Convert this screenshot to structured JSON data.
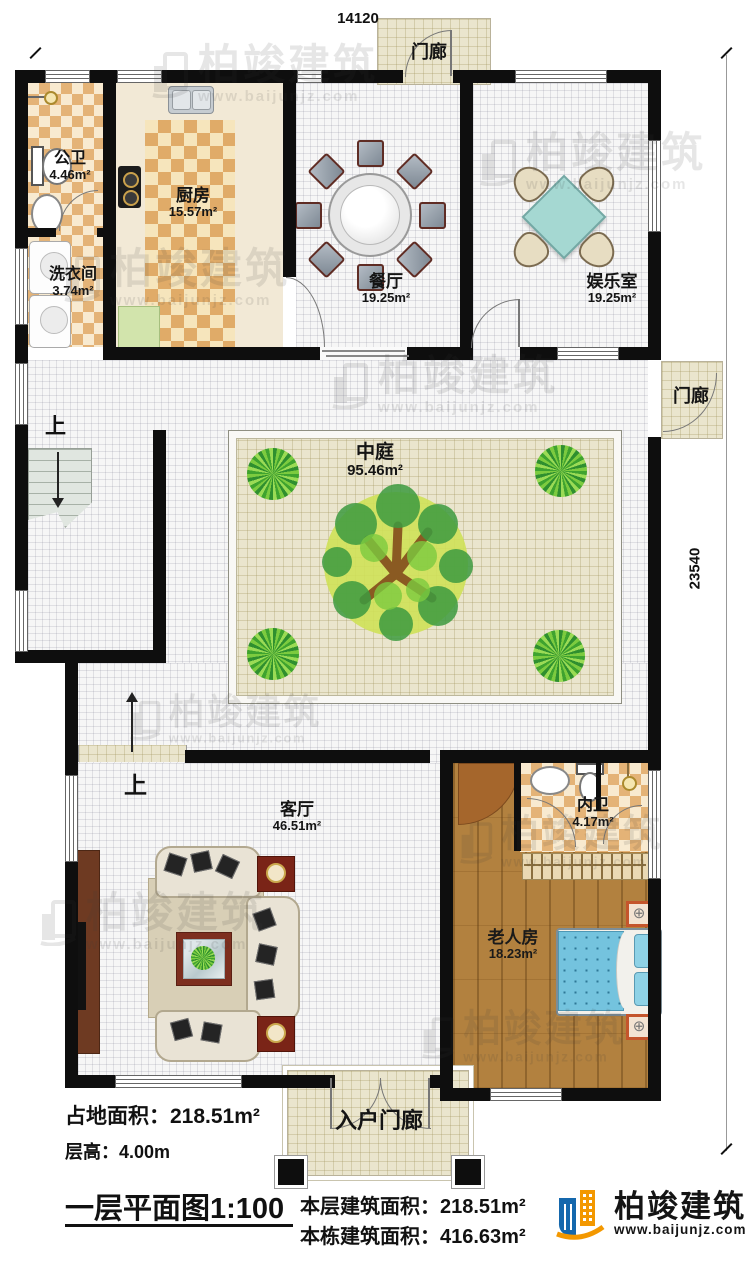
{
  "dims": {
    "top": "14120",
    "right": "23540"
  },
  "rooms": [
    {
      "name": "公卫",
      "area": "4.46m²"
    },
    {
      "name": "洗衣间",
      "area": "3.74m²"
    },
    {
      "name": "厨房",
      "area": "15.57m²"
    },
    {
      "name": "餐厅",
      "area": "19.25m²"
    },
    {
      "name": "娱乐室",
      "area": "19.25m²"
    },
    {
      "name": "中庭",
      "area": "95.46m²"
    },
    {
      "name": "客厅",
      "area": "46.51m²"
    },
    {
      "name": "内卫",
      "area": "4.17m²"
    },
    {
      "name": "老人房",
      "area": "18.23m²"
    }
  ],
  "porches": {
    "top": "门廊",
    "right": "门廊",
    "entrance": "入户门廊"
  },
  "labels": {
    "up": "上"
  },
  "watermark": {
    "text": "柏竣建筑",
    "url": "www.baijunjz.com"
  },
  "footer": {
    "land_area_label": "占地面积：",
    "land_area": "218.51m²",
    "floor_height_label": "层高：",
    "floor_height": "4.00m",
    "plan_title": "一层平面图1:100",
    "floor_area_label": "本层建筑面积：",
    "floor_area": "218.51m²",
    "building_area_label": "本栋建筑面积：",
    "building_area": "416.63m²"
  },
  "logo": {
    "name": "柏竣建筑",
    "url": "www.baijunjz.com"
  }
}
